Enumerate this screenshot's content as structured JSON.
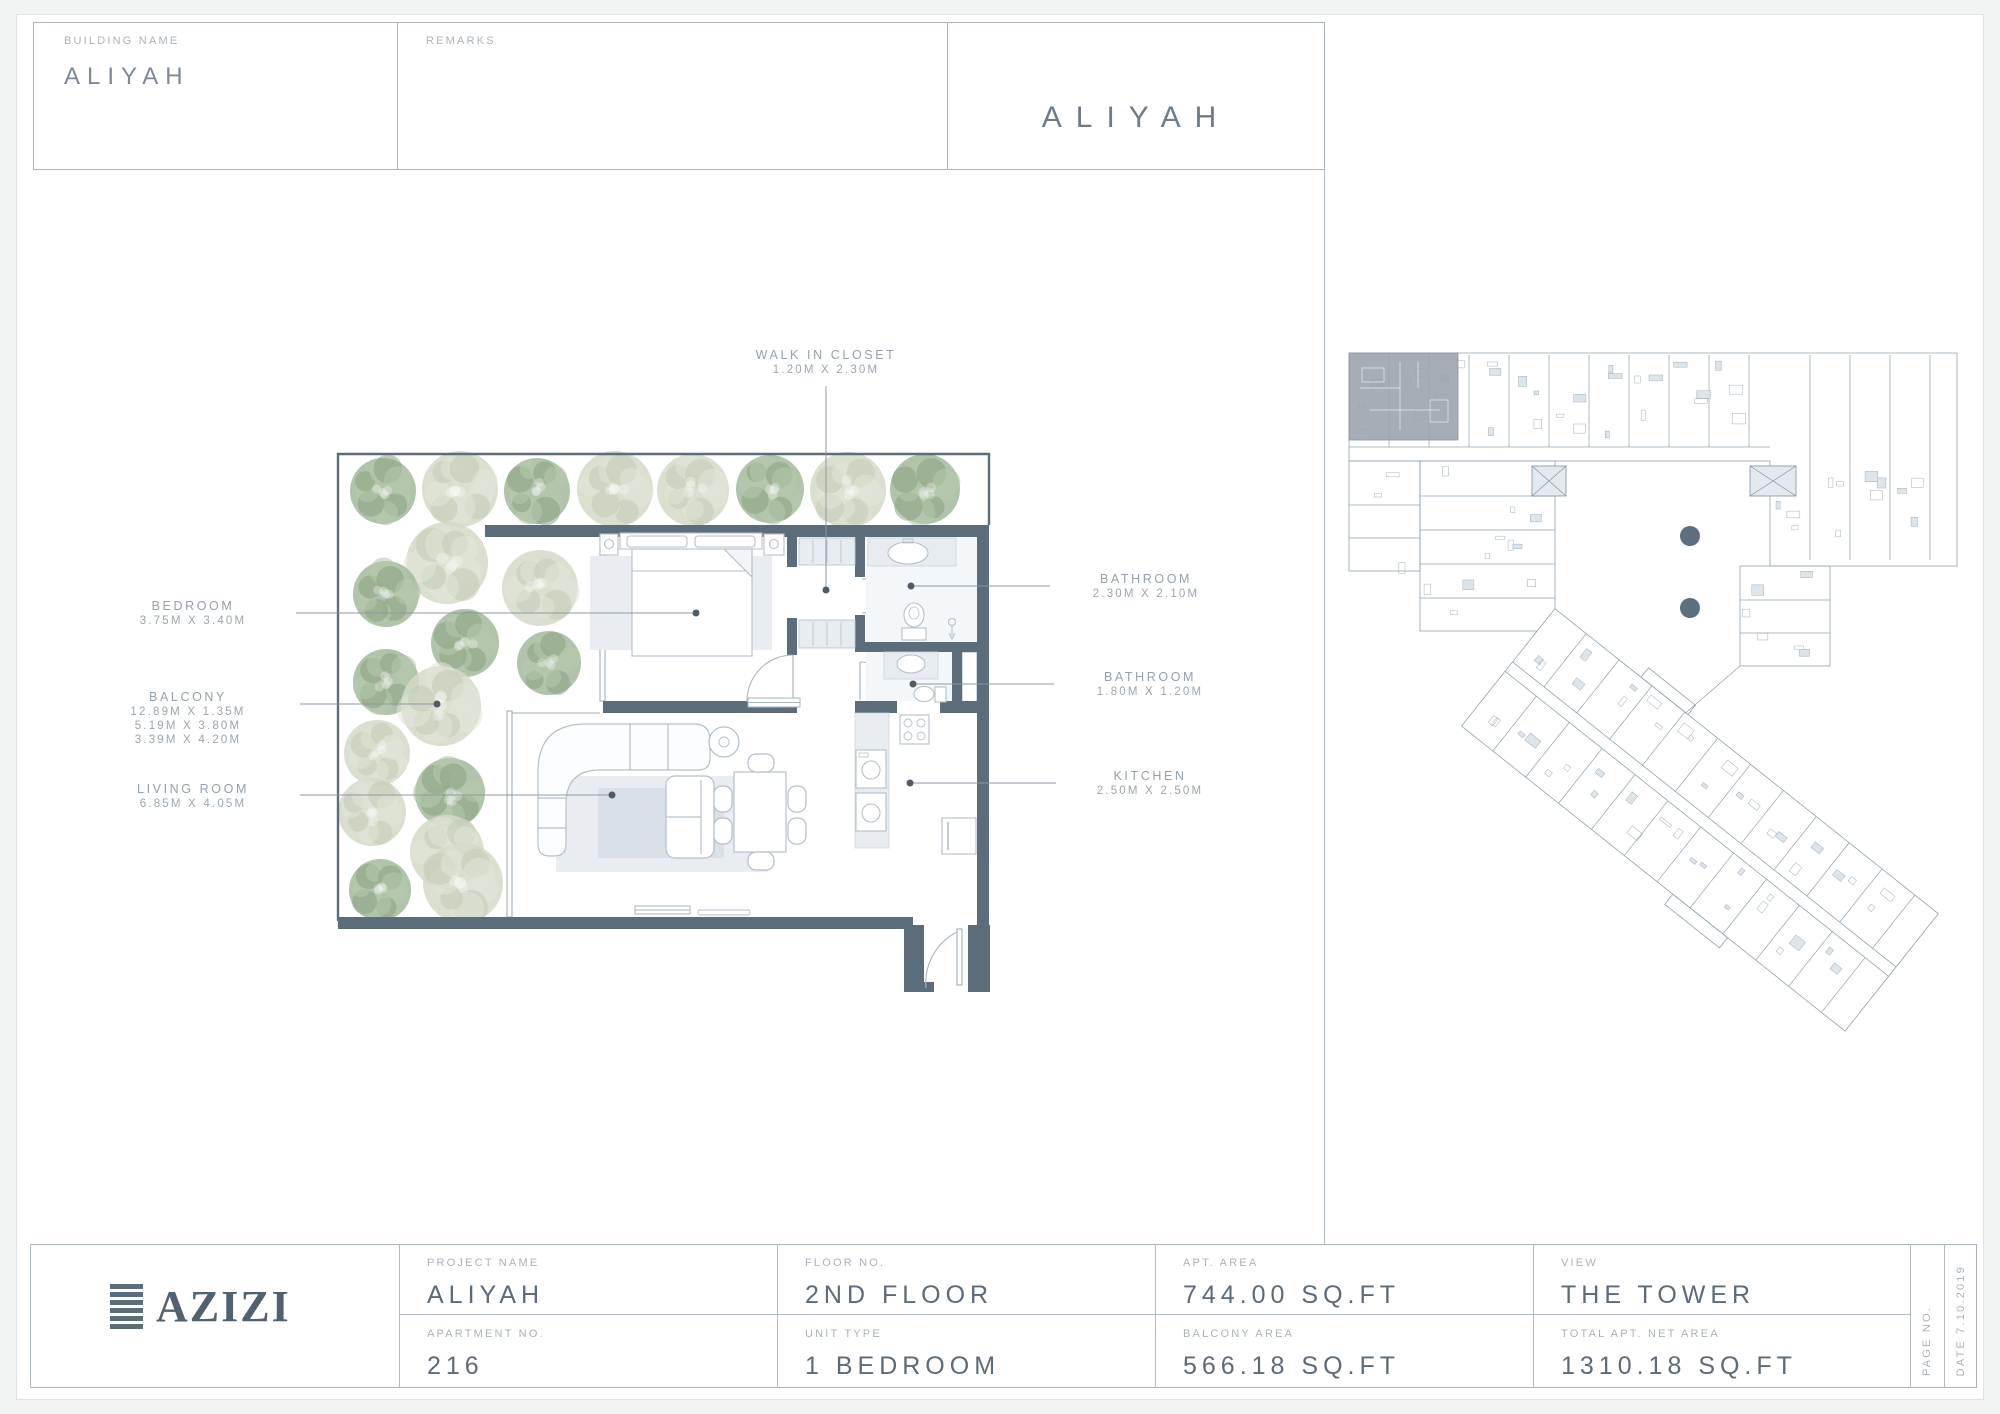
{
  "header": {
    "building_name_label": "BUILDING NAME",
    "building_name_value": "ALIYAH",
    "remarks_label": "REMARKS",
    "title": "ALIYAH"
  },
  "plan": {
    "labels": {
      "walk_in_closet": {
        "name": "WALK IN CLOSET",
        "dim": "1.20M X 2.30M"
      },
      "bedroom": {
        "name": "BEDROOM",
        "dim": "3.75M X 3.40M"
      },
      "balcony": {
        "name": "BALCONY",
        "dims": [
          "12.89M X 1.35M",
          "5.19M X 3.80M",
          "3.39M X 4.20M"
        ]
      },
      "living_room": {
        "name": "LIVING ROOM",
        "dim": "6.85M X 4.05M"
      },
      "bathroom_1": {
        "name": "BATHROOM",
        "dim": "2.30M X 2.10M"
      },
      "bathroom_2": {
        "name": "BATHROOM",
        "dim": "1.80M X 1.20M"
      },
      "kitchen": {
        "name": "KITCHEN",
        "dim": "2.50M X 2.50M"
      }
    }
  },
  "footer": {
    "logo_text": "AZIZI",
    "cells": [
      {
        "label": "PROJECT NAME",
        "value": "ALIYAH"
      },
      {
        "label": "FLOOR NO.",
        "value": "2ND FLOOR"
      },
      {
        "label": "APT. AREA",
        "value": "744.00 SQ.FT"
      },
      {
        "label": "VIEW",
        "value": "THE TOWER"
      },
      {
        "label": "APARTMENT NO.",
        "value": "216"
      },
      {
        "label": "UNIT TYPE",
        "value": "1 BEDROOM"
      },
      {
        "label": "BALCONY AREA",
        "value": "566.18 SQ.FT"
      },
      {
        "label": "TOTAL APT. NET AREA",
        "value": "1310.18 SQ.FT"
      }
    ],
    "page_no_label": "PAGE NO.",
    "date_label": "DATE 7.10.2019"
  },
  "colors": {
    "wall": "#5b6c7b",
    "leader": "#8e99a4",
    "highlight_unit": "#9aa2ac"
  }
}
